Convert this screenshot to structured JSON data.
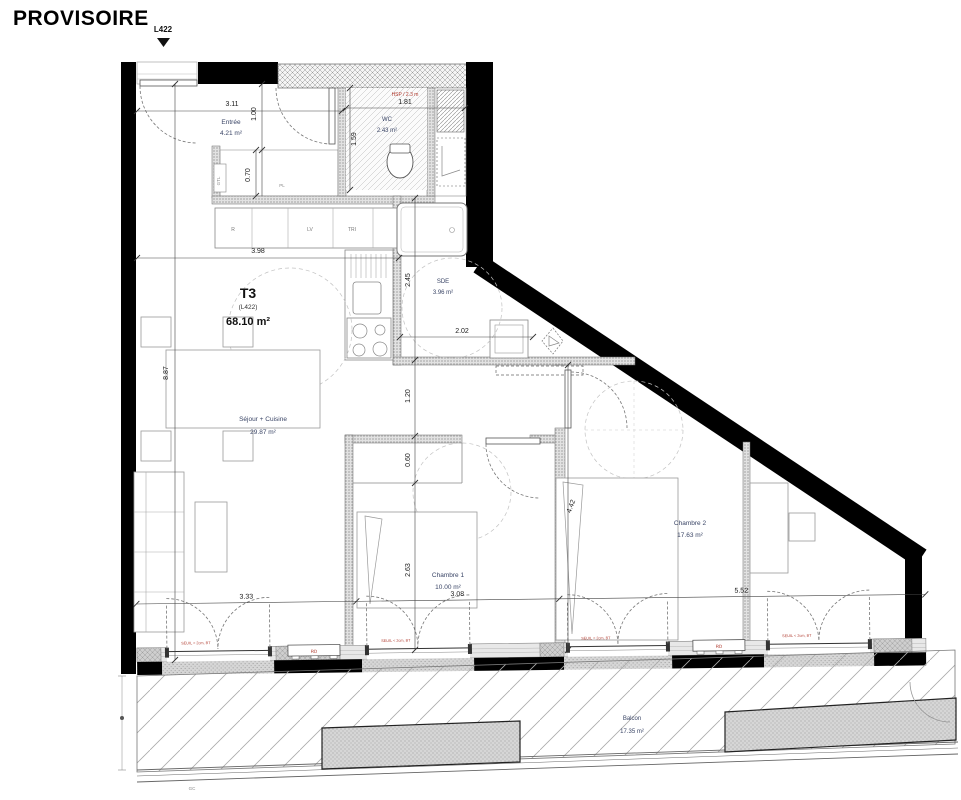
{
  "header": {
    "title": "PROVISOIRE",
    "marker": "L422"
  },
  "unit": {
    "code": "T3",
    "lot": "(L422)",
    "area": "68.10 m²"
  },
  "rooms": {
    "entree": {
      "name": "Entrée",
      "area": "4.21 m²"
    },
    "wc": {
      "name": "WC",
      "area": "2.43 m²"
    },
    "sde": {
      "name": "SDE",
      "area": "3.96 m²"
    },
    "sejour": {
      "name": "Séjour + Cuisine",
      "area": "29.87 m²"
    },
    "chambre1": {
      "name": "Chambre 1",
      "area": "10.00 m²"
    },
    "chambre2": {
      "name": "Chambre 2",
      "area": "17.63 m²"
    },
    "balcon": {
      "name": "Balcon",
      "area": "17.35 m²"
    }
  },
  "dims": {
    "entree_w": "3.11",
    "entree_d": "1.00",
    "wc_w": "1.81",
    "wc_h": "1.59",
    "placard": "0.70",
    "sejour_top": "3.98",
    "sde_h": "2.45",
    "sde_w": "2.02",
    "sejour_h": "8.87",
    "couloir": "1.20",
    "placard_ch1": "0.60",
    "ch1_h": "2.63",
    "ch2_h": "4.42",
    "bottom_sejour": "3.33",
    "bottom_ch1": "3.08",
    "bottom_ch2": "5.52"
  },
  "annotations": {
    "hsp": "HSP / 2.3 m",
    "seuil": "SEUIL < 2cm, BT",
    "rd": "RD",
    "placard": "PL",
    "gtl": "GTL",
    "gc": "GC"
  },
  "kitchen": {
    "fridge": "R",
    "dishwasher": "LV",
    "trash": "TRI"
  },
  "colors": {
    "wall": "#000000",
    "room_label": "#3a4566",
    "alert": "#b03a2e",
    "dim": "#1a1a1a",
    "hatch": "#9a9a9a"
  }
}
